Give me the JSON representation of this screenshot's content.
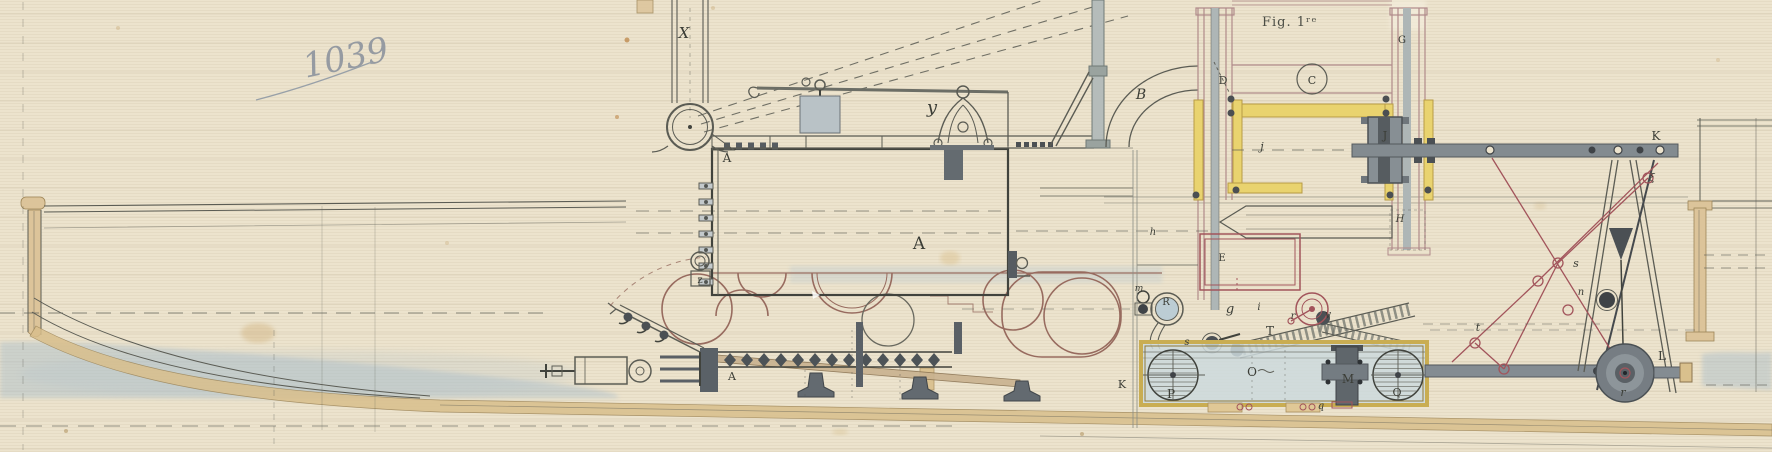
{
  "document": {
    "handwritten_number": "1039",
    "figure_label": "Fig. 1ʳᵉ"
  },
  "palette": {
    "paper": "#ece3cd",
    "ink": "#5b5c54",
    "ink_dark": "#3c3e39",
    "brown_outline": "#8f5f54",
    "red_lattice": "#a2545b",
    "yellow_highlight": "#e9d36f",
    "wood_tan": "#dcc49a",
    "water_blue": "#aec0cb",
    "metal_gray": "#7c848a",
    "pencil_gray": "#8d949e"
  },
  "diagram": {
    "part_labels": [
      {
        "text": "X",
        "x": 684,
        "y": 38,
        "size": 15,
        "italic": true
      },
      {
        "text": "y",
        "x": 932,
        "y": 113,
        "size": 18,
        "italic": true
      },
      {
        "text": "B",
        "x": 1141,
        "y": 99,
        "size": 14,
        "italic": true
      },
      {
        "text": "D",
        "x": 1223,
        "y": 84,
        "size": 11,
        "italic": false
      },
      {
        "text": "A",
        "x": 727,
        "y": 162,
        "size": 12,
        "italic": false
      },
      {
        "text": "A",
        "x": 919,
        "y": 249,
        "size": 17,
        "italic": false
      },
      {
        "text": "z",
        "x": 700,
        "y": 283,
        "size": 10,
        "italic": false
      },
      {
        "text": "A",
        "x": 732,
        "y": 380,
        "size": 11,
        "italic": false
      },
      {
        "text": "C",
        "x": 1312,
        "y": 84,
        "size": 11,
        "italic": false
      },
      {
        "text": "G",
        "x": 1402,
        "y": 43,
        "size": 10,
        "italic": false
      },
      {
        "text": "J",
        "x": 1385,
        "y": 139,
        "size": 11,
        "italic": false,
        "color": "#26292c"
      },
      {
        "text": "j",
        "x": 1262,
        "y": 150,
        "size": 11,
        "italic": true
      },
      {
        "text": "H",
        "x": 1400,
        "y": 222,
        "size": 10,
        "italic": true
      },
      {
        "text": "K",
        "x": 1656,
        "y": 140,
        "size": 12,
        "italic": false
      },
      {
        "text": "ξ",
        "x": 1652,
        "y": 181,
        "size": 10,
        "italic": true,
        "color": "#8a4a44"
      },
      {
        "text": "s",
        "x": 1576,
        "y": 267,
        "size": 11,
        "italic": true
      },
      {
        "text": "n",
        "x": 1581,
        "y": 295,
        "size": 10,
        "italic": true
      },
      {
        "text": "t",
        "x": 1478,
        "y": 331,
        "size": 11,
        "italic": true
      },
      {
        "text": "L",
        "x": 1662,
        "y": 360,
        "size": 12,
        "italic": false
      },
      {
        "text": "r",
        "x": 1623,
        "y": 396,
        "size": 11,
        "italic": true,
        "color": "#1d2023"
      },
      {
        "text": "P",
        "x": 1171,
        "y": 398,
        "size": 12,
        "italic": false
      },
      {
        "text": "O",
        "x": 1252,
        "y": 376,
        "size": 12,
        "italic": false
      },
      {
        "text": "M",
        "x": 1348,
        "y": 383,
        "size": 12,
        "italic": false,
        "color": "#15181b"
      },
      {
        "text": "Q",
        "x": 1397,
        "y": 396,
        "size": 11,
        "italic": false
      },
      {
        "text": "E",
        "x": 1222,
        "y": 261,
        "size": 10,
        "italic": false
      },
      {
        "text": "R",
        "x": 1166,
        "y": 305,
        "size": 10,
        "italic": false
      },
      {
        "text": "m",
        "x": 1139,
        "y": 291,
        "size": 9,
        "italic": true
      },
      {
        "text": "g",
        "x": 1230,
        "y": 313,
        "size": 13,
        "italic": true
      },
      {
        "text": "i",
        "x": 1259,
        "y": 310,
        "size": 10,
        "italic": true
      },
      {
        "text": "r",
        "x": 1293,
        "y": 319,
        "size": 10,
        "italic": true
      },
      {
        "text": "v",
        "x": 1328,
        "y": 318,
        "size": 11,
        "italic": true
      },
      {
        "text": "T",
        "x": 1270,
        "y": 335,
        "size": 12,
        "italic": false
      },
      {
        "text": "s",
        "x": 1187,
        "y": 345,
        "size": 10,
        "italic": true
      },
      {
        "text": "K",
        "x": 1122,
        "y": 388,
        "size": 11,
        "italic": false
      },
      {
        "text": "q",
        "x": 1321,
        "y": 409,
        "size": 10,
        "italic": true
      },
      {
        "text": "h",
        "x": 1153,
        "y": 235,
        "size": 10,
        "italic": true
      }
    ]
  }
}
